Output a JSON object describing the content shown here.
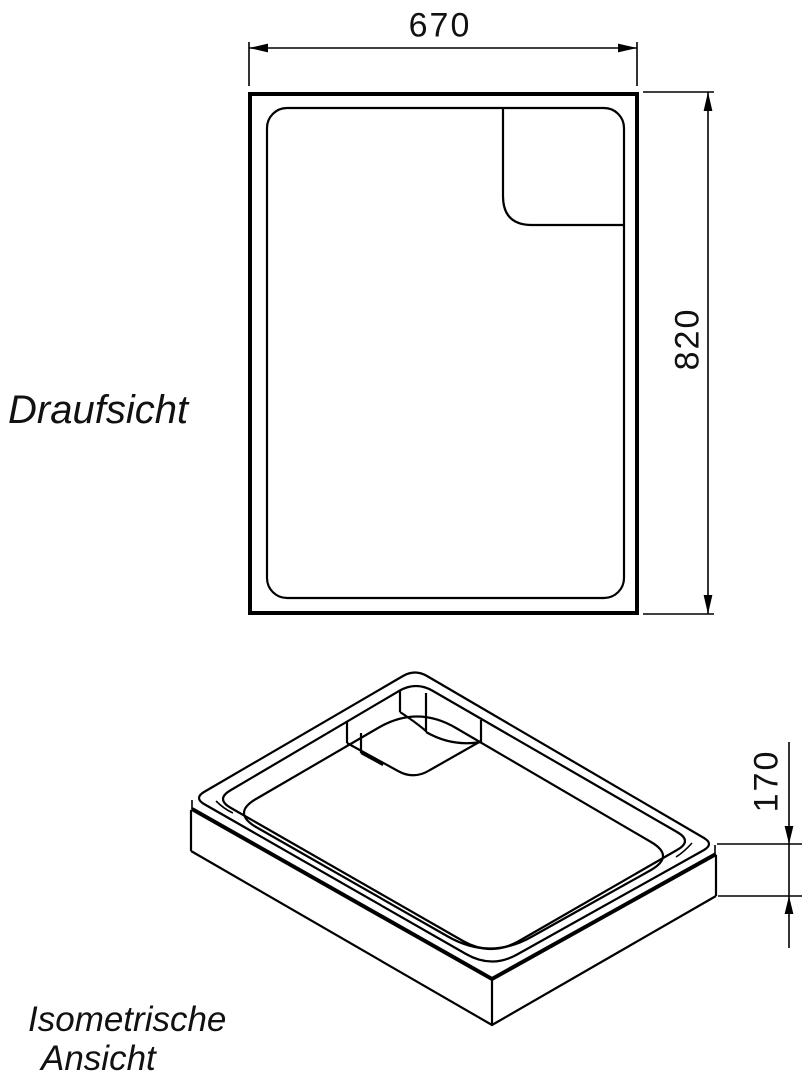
{
  "drawing": {
    "type": "technical-drawing",
    "subject": "shower tray support",
    "line_color": "#000000",
    "background_color": "#ffffff"
  },
  "top_view": {
    "label": "Draufsicht",
    "width_dim": "670",
    "height_dim": "820"
  },
  "iso_view": {
    "label_line1": "Isometrische",
    "label_line2": "Ansicht",
    "depth_dim": "170"
  }
}
